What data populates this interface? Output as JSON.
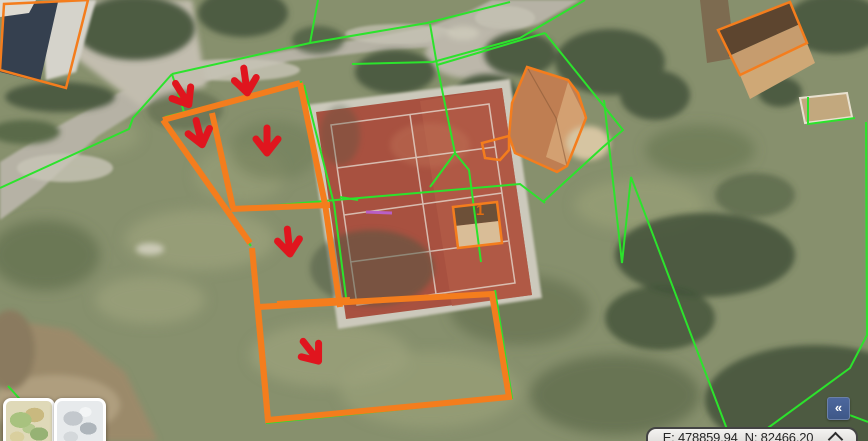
{
  "app": {
    "name": "gis-map-viewer"
  },
  "status_bar": {
    "easting": "E: 478859.94",
    "northing": "N: 82466.20",
    "collapse_icon": "chevron-up"
  },
  "panel_button": {
    "glyph": "«"
  },
  "layer_picker": {
    "items": [
      {
        "name": "topographic-overview-map"
      },
      {
        "name": "orthophoto-map"
      }
    ]
  },
  "map": {
    "width": 868,
    "height": 441,
    "palette": {
      "cadastral_green": "#2ce32c",
      "parcel_orange": "#f47d1d",
      "arrow_red": "#e0151e",
      "label_orange": "#e06c10",
      "annotation_magenta": "#b95fc5"
    },
    "green_lines": [
      [
        [
          0,
          188
        ],
        [
          129,
          129
        ],
        [
          133,
          118
        ],
        [
          172,
          74
        ]
      ],
      [
        [
          172,
          74
        ],
        [
          310,
          43
        ],
        [
          427,
          23
        ],
        [
          510,
          2
        ]
      ],
      [
        [
          310,
          43
        ],
        [
          318,
          0
        ]
      ],
      [
        [
          172,
          74
        ],
        [
          184,
          112
        ]
      ],
      [
        [
          352,
          64
        ],
        [
          433,
          62
        ],
        [
          520,
          38
        ],
        [
          585,
          0
        ]
      ],
      [
        [
          545,
          33
        ],
        [
          437,
          65
        ],
        [
          455,
          153
        ],
        [
          430,
          187
        ]
      ],
      [
        [
          430,
          24
        ],
        [
          437,
          65
        ]
      ],
      [
        [
          233,
          209
        ],
        [
          520,
          184
        ],
        [
          545,
          203
        ]
      ],
      [
        [
          455,
          153
        ],
        [
          469,
          170
        ],
        [
          481,
          262
        ]
      ],
      [
        [
          545,
          33
        ],
        [
          623,
          130
        ],
        [
          603,
          147
        ],
        [
          543,
          202
        ]
      ],
      [
        [
          604,
          100
        ],
        [
          622,
          263
        ],
        [
          631,
          177
        ],
        [
          733,
          445
        ]
      ],
      [
        [
          866,
          122
        ],
        [
          867,
          335
        ],
        [
          850,
          368
        ],
        [
          750,
          441
        ]
      ],
      [
        [
          808,
          97
        ],
        [
          808,
          124
        ],
        [
          855,
          118
        ]
      ],
      [
        [
          8,
          386
        ],
        [
          58,
          441
        ]
      ],
      [
        [
          165,
          117
        ],
        [
          302,
          82
        ]
      ],
      [
        [
          304,
          85
        ],
        [
          334,
          204
        ],
        [
          347,
          305
        ]
      ],
      [
        [
          163,
          122
        ],
        [
          251,
          246
        ]
      ],
      [
        [
          495,
          290
        ],
        [
          512,
          398
        ],
        [
          266,
          423
        ]
      ],
      [
        [
          340,
          197
        ],
        [
          358,
          200
        ]
      ],
      [
        [
          828,
          407
        ],
        [
          868,
          422
        ]
      ]
    ],
    "orange_parcel_lines": [
      [
        [
          163,
          120
        ],
        [
          300,
          83
        ]
      ],
      [
        [
          163,
          120
        ],
        [
          250,
          243
        ]
      ],
      [
        [
          212,
          113
        ],
        [
          233,
          208
        ]
      ],
      [
        [
          231,
          209
        ],
        [
          330,
          205
        ]
      ],
      [
        [
          300,
          83
        ],
        [
          325,
          204
        ],
        [
          340,
          307
        ]
      ],
      [
        [
          252,
          248
        ],
        [
          268,
          420
        ]
      ],
      [
        [
          277,
          304
        ],
        [
          350,
          300
        ]
      ]
    ],
    "orange_parcel_polygons": [
      [
        [
          258,
          307
        ],
        [
          492,
          294
        ],
        [
          509,
          397
        ],
        [
          268,
          420
        ]
      ]
    ],
    "building_outlines": [
      [
        [
          0,
          70
        ],
        [
          4,
          4
        ],
        [
          88,
          0
        ],
        [
          66,
          88
        ]
      ],
      [
        [
          718,
          30
        ],
        [
          790,
          2
        ],
        [
          807,
          43
        ],
        [
          740,
          75
        ]
      ],
      [
        [
          527,
          67
        ],
        [
          568,
          80
        ],
        [
          578,
          93
        ],
        [
          586,
          118
        ],
        [
          567,
          166
        ],
        [
          557,
          172
        ],
        [
          515,
          153
        ],
        [
          509,
          136
        ],
        [
          512,
          103
        ]
      ],
      [
        [
          509,
          136
        ],
        [
          482,
          143
        ],
        [
          485,
          158
        ],
        [
          500,
          160
        ],
        [
          509,
          150
        ]
      ],
      [
        [
          453,
          207
        ],
        [
          497,
          202
        ],
        [
          502,
          243
        ],
        [
          458,
          248
        ]
      ]
    ],
    "arrows": [
      {
        "x": 184,
        "y": 97,
        "angle": -32
      },
      {
        "x": 246,
        "y": 84,
        "angle": -8
      },
      {
        "x": 200,
        "y": 136,
        "angle": -14
      },
      {
        "x": 267,
        "y": 144,
        "angle": 0
      },
      {
        "x": 289,
        "y": 245,
        "angle": -6
      },
      {
        "x": 313,
        "y": 354,
        "angle": -38
      }
    ],
    "labels": [
      {
        "text": "1",
        "x": 480,
        "y": 215
      }
    ],
    "magenta_lines": [
      [
        [
          366,
          212
        ],
        [
          392,
          213
        ]
      ]
    ]
  }
}
